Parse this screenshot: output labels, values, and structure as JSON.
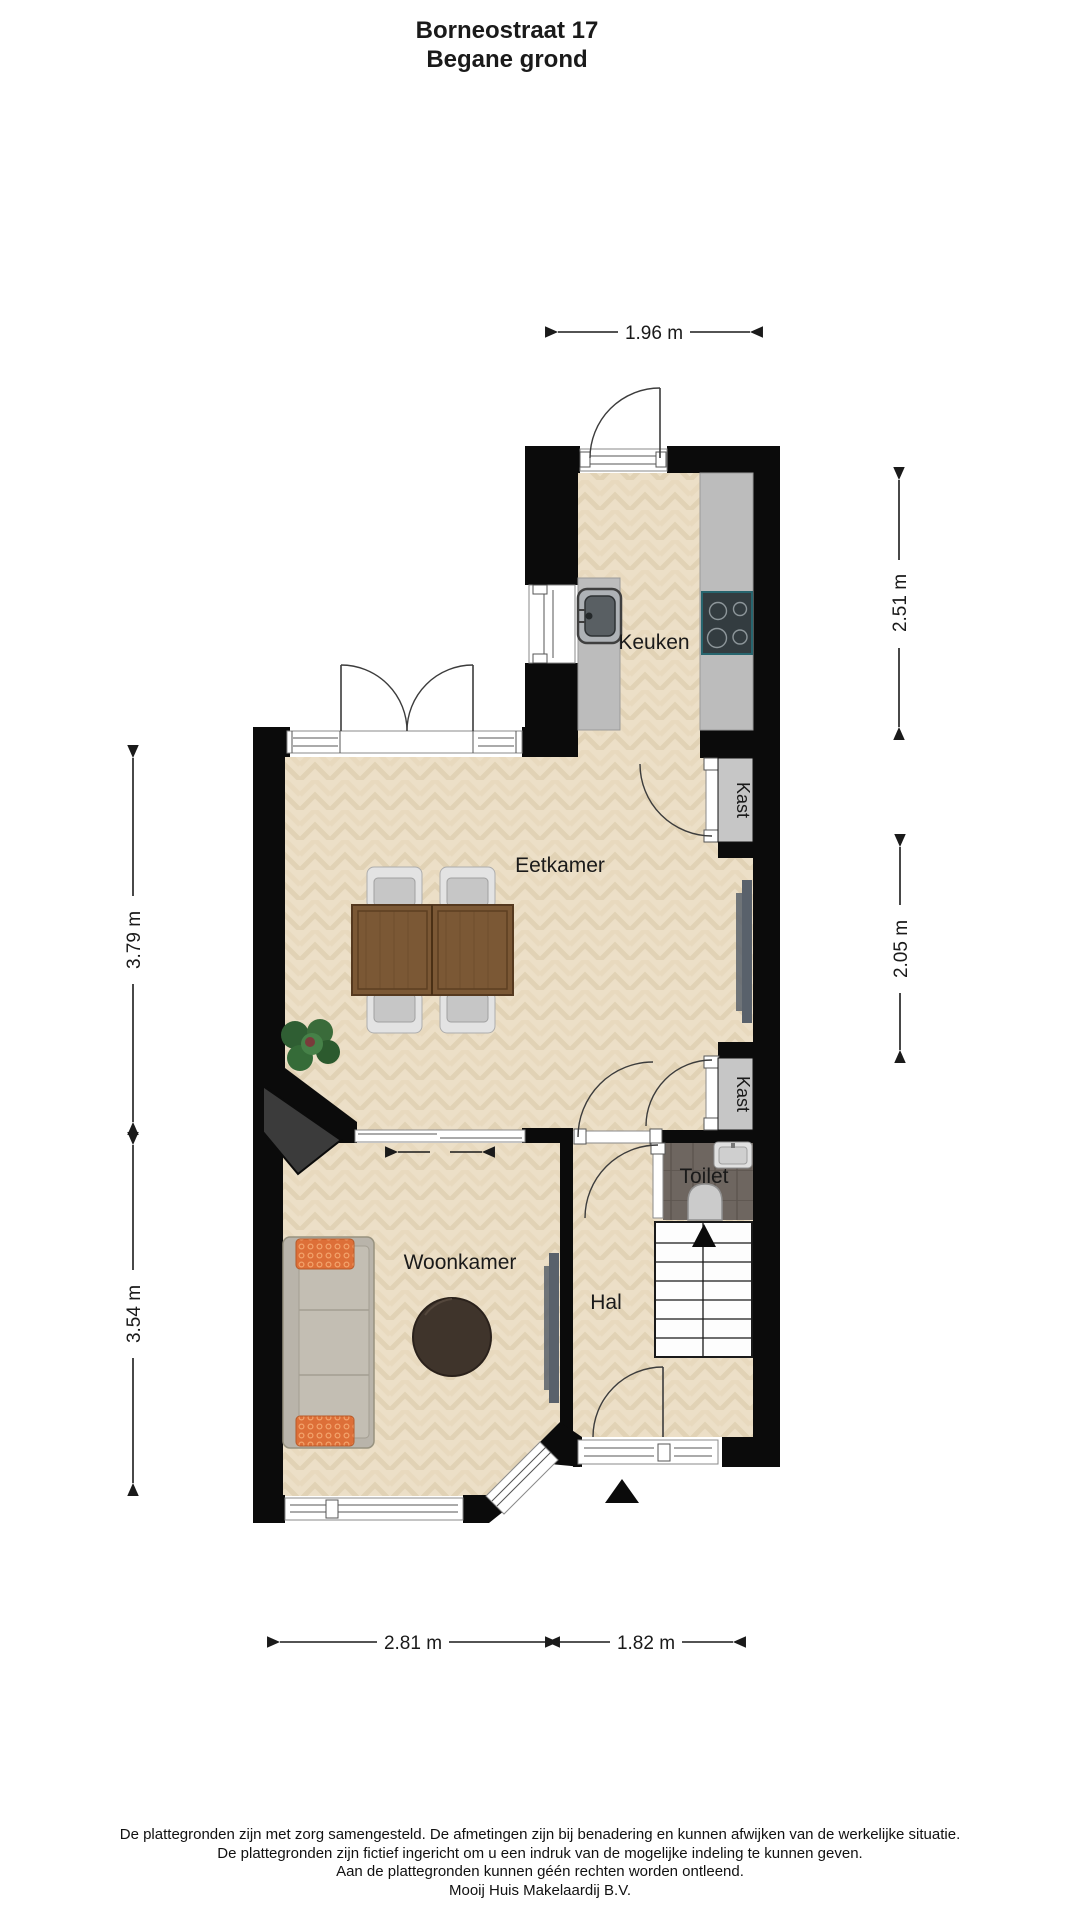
{
  "title": {
    "line1": "Borneostraat 17",
    "line2": "Begane grond"
  },
  "labels": {
    "keuken": "Keuken",
    "eetkamer": "Eetkamer",
    "woonkamer": "Woonkamer",
    "hal": "Hal",
    "toilet": "Toilet",
    "kast_boven": "Kast",
    "kast_onder": "Kast"
  },
  "dimensions": {
    "top_width": "1.96 m",
    "right_upper": "2.51 m",
    "right_lower": "2.05 m",
    "left_upper": "3.79 m",
    "left_lower": "3.54 m",
    "bottom_left": "2.81 m",
    "bottom_right": "1.82 m"
  },
  "footer": {
    "line1": "De plattegronden zijn met zorg samengesteld. De afmetingen zijn bij benadering en kunnen afwijken van de werkelijke situatie.",
    "line2": "De plattegronden zijn fictief ingericht om u een indruk van de mogelijke indeling te kunnen geven.",
    "line3": "Aan de plattegronden kunnen géén rechten worden ontleend.",
    "line4": "Mooij Huis Makelaardij B.V."
  },
  "colors": {
    "wall": "#0b0b0b",
    "floor": "#ecdfc7",
    "counter": "#bcbcbc",
    "toilet_tile": "#6e6660",
    "pillow_accent": "#dd6f38",
    "table_wood": "#7b5835"
  }
}
